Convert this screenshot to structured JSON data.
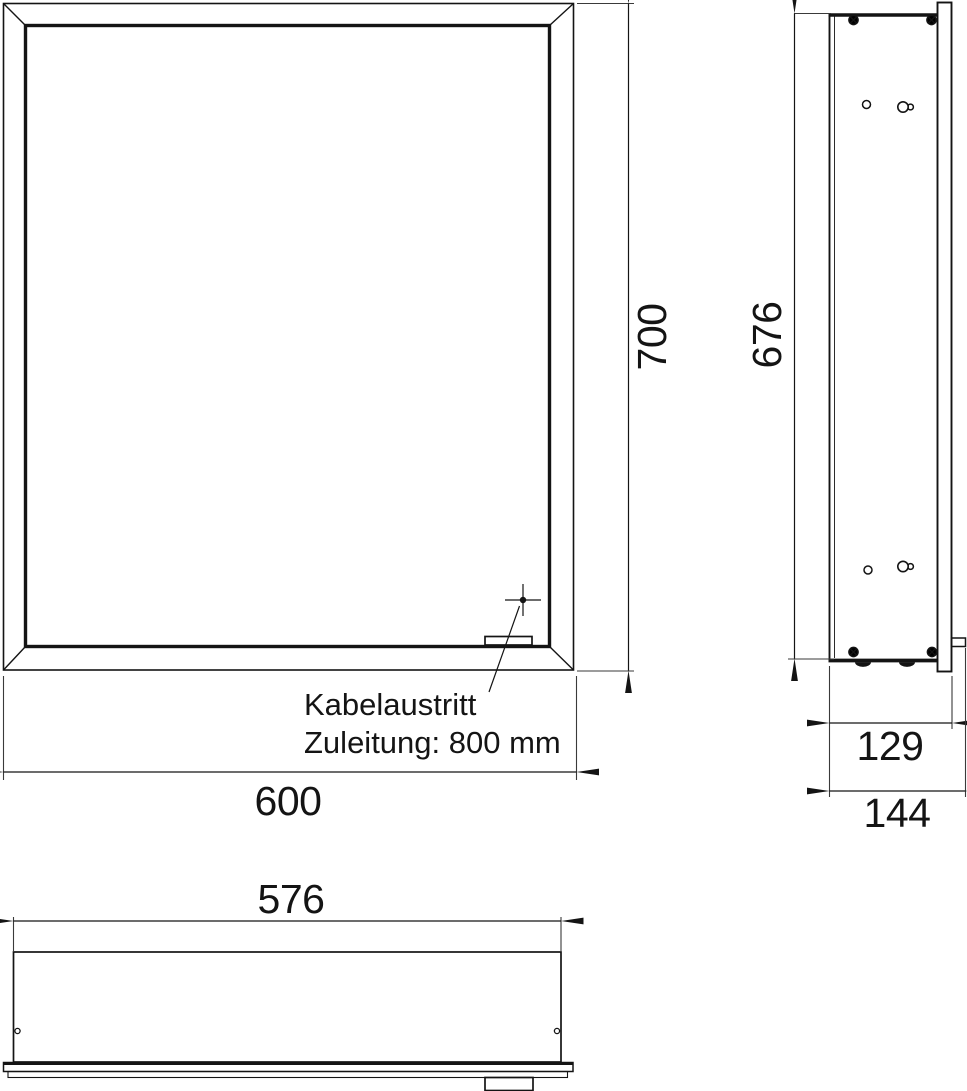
{
  "drawing": {
    "type": "technical-dimension-drawing",
    "subject": "mirror-cabinet",
    "views": [
      "front",
      "side",
      "bottom"
    ]
  },
  "dimension_labels": {
    "front_width": "600",
    "front_height": "700",
    "side_body_height": "676",
    "side_body_depth": "129",
    "side_total_depth": "144",
    "bottom_body_width": "576"
  },
  "annotations": {
    "cable_exit_label": "Kabelaustritt",
    "cable_supply_label": "Zuleitung: 800 mm"
  },
  "colors": {
    "line": "#141414",
    "background": "#ffffff"
  }
}
